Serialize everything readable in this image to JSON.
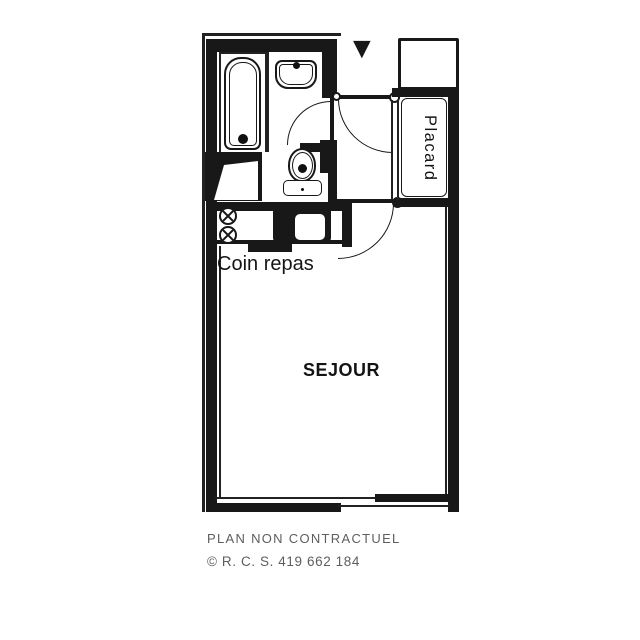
{
  "plan": {
    "rooms": {
      "placard": "Placard",
      "coin_repas": "Coin repas",
      "sejour": "SEJOUR"
    },
    "entrance_marker": "▼",
    "colors": {
      "ink": "#181818",
      "paper": "#ffffff",
      "footer_text": "#5e5e5e"
    }
  },
  "footer": {
    "disclaimer": "PLAN NON CONTRACTUEL",
    "registration": "© R. C. S. 419 662 184"
  }
}
